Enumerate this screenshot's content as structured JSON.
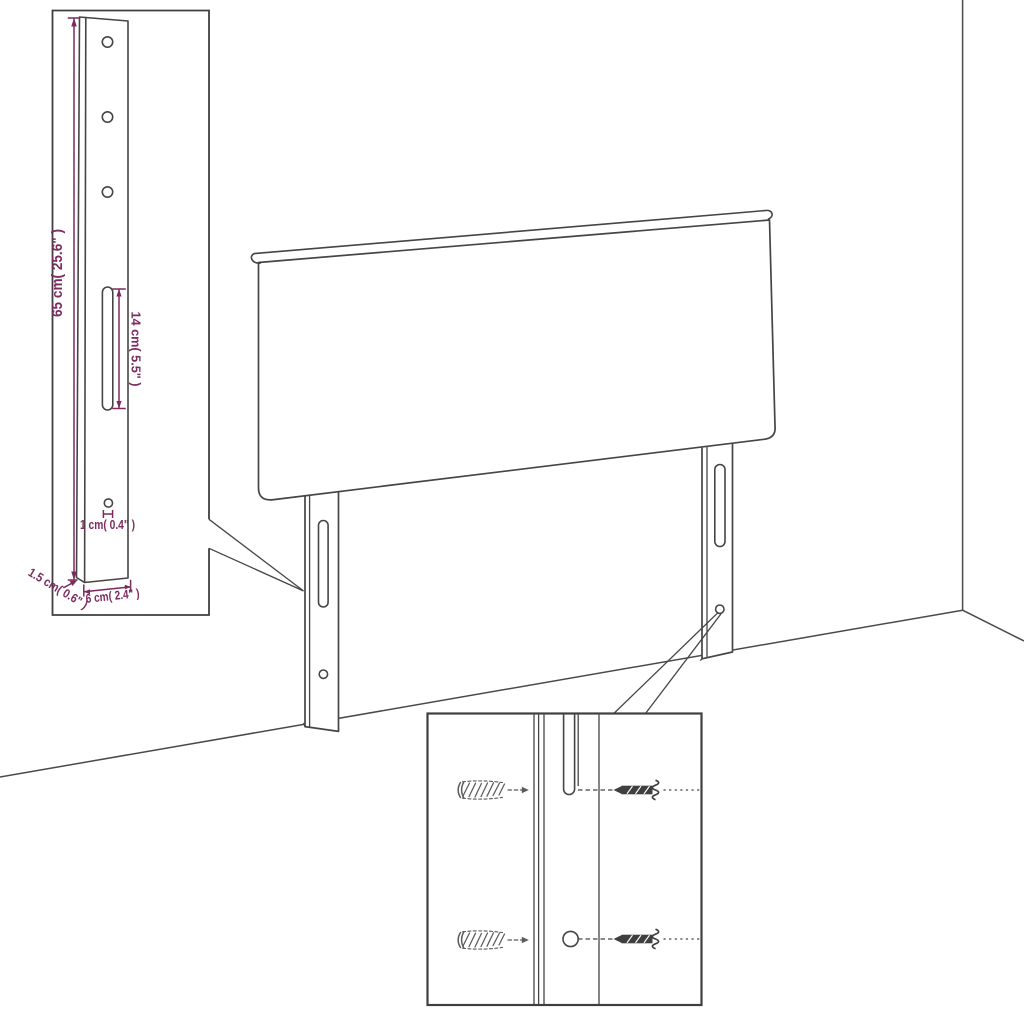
{
  "diagram": {
    "colors": {
      "line": "#454545",
      "dimension": "#7c2b5e",
      "background": "#ffffff"
    },
    "bracket_inset": {
      "labels": {
        "height": "65 cm( 25.6\" )",
        "slot_length": "14 cm( 5.5\" )",
        "hole_diameter": "1 cm( 0.4\" )",
        "thickness": "1.5 cm( 0.6\" )",
        "width": "6 cm( 2.4\" )"
      }
    }
  }
}
